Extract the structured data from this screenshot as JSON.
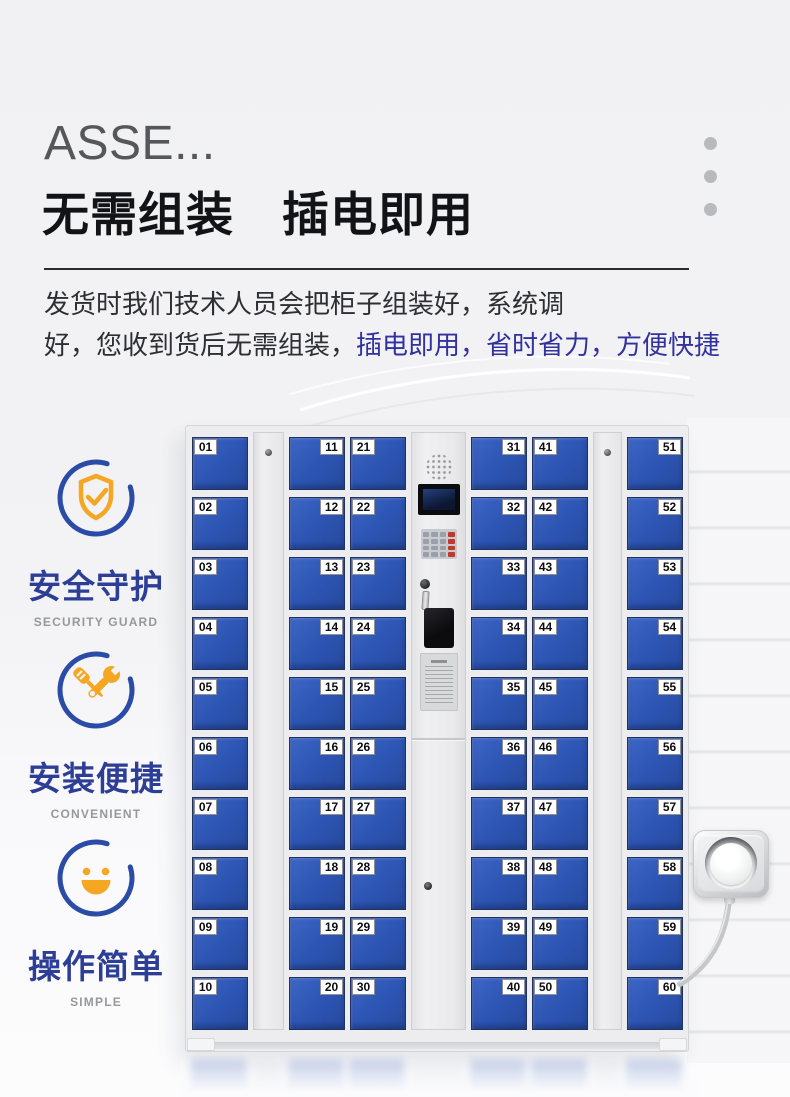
{
  "header": {
    "title_en": "ASSE...",
    "title_zh": "无需组装　插电即用"
  },
  "intro": {
    "line1": "发货时我们技术人员会把柜子组装好，系统调",
    "line2_black": "好，您收到货后无需组装，",
    "line2_blue": "插电即用，省时省力，方便快捷"
  },
  "features": [
    {
      "icon": "shield-check-icon",
      "title": "安全守护",
      "subtitle": "SECURITY GUARD"
    },
    {
      "icon": "wrench-screwdriver-icon",
      "title": "安装便捷",
      "subtitle": "CONVENIENT"
    },
    {
      "icon": "smiley-face-icon",
      "title": "操作简单",
      "subtitle": "SIMPLE"
    }
  ],
  "cabinet": {
    "columns": [
      {
        "type": "doors",
        "label_side": "left",
        "numbers": [
          "01",
          "02",
          "03",
          "04",
          "05",
          "06",
          "07",
          "08",
          "09",
          "10"
        ]
      },
      {
        "type": "strip"
      },
      {
        "type": "doors",
        "label_side": "right",
        "numbers": [
          "11",
          "12",
          "13",
          "14",
          "15",
          "16",
          "17",
          "18",
          "19",
          "20"
        ]
      },
      {
        "type": "doors",
        "label_side": "left",
        "numbers": [
          "21",
          "22",
          "23",
          "24",
          "25",
          "26",
          "27",
          "28",
          "29",
          "30"
        ]
      },
      {
        "type": "control-panel"
      },
      {
        "type": "doors",
        "label_side": "right",
        "numbers": [
          "31",
          "32",
          "33",
          "34",
          "35",
          "36",
          "37",
          "38",
          "39",
          "40"
        ]
      },
      {
        "type": "doors",
        "label_side": "left",
        "numbers": [
          "41",
          "42",
          "43",
          "44",
          "45",
          "46",
          "47",
          "48",
          "49",
          "50"
        ]
      },
      {
        "type": "strip"
      },
      {
        "type": "doors",
        "label_side": "right",
        "numbers": [
          "51",
          "52",
          "53",
          "54",
          "55",
          "56",
          "57",
          "58",
          "59",
          "60"
        ]
      }
    ]
  },
  "colors": {
    "door_blue": "#2d55b4",
    "accent_orange": "#f5a623",
    "feature_title_blue": "#2c3e95",
    "intro_highlight_blue": "#32329e",
    "heading_black": "#121317",
    "heading_gray": "#56575b"
  }
}
